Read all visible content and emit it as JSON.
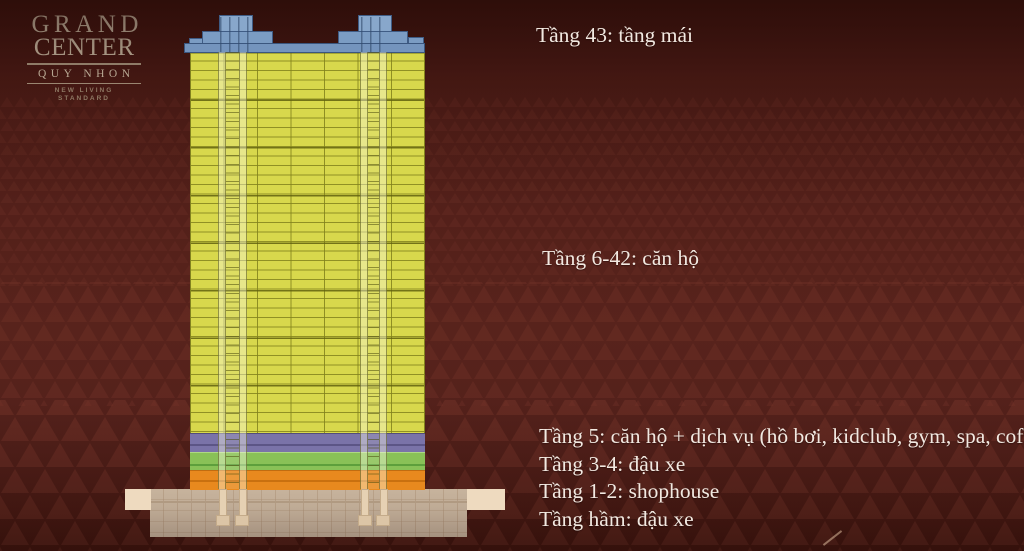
{
  "logo": {
    "title_line1": "GRAND",
    "title_line2": "CENTER",
    "subtitle": "QUY NHON",
    "tagline": "NEW LIVING STANDARD"
  },
  "annotations": {
    "roof": "Tầng 43: tầng mái",
    "apartments": "Tầng 6-42: căn hộ",
    "floor5": "Tầng 5: căn hộ + dịch vụ (hồ bơi, kidclub, gym, spa, coffee…",
    "floor3_4": "Tầng 3-4: đậu xe",
    "floor1_2": "Tầng 1-2: shophouse",
    "basement": "Tầng hầm: đậu xe"
  },
  "building": {
    "sections": [
      {
        "floors": "Tầng 43",
        "use": "tầng mái",
        "color": "#7b9cc3"
      },
      {
        "floors": "Tầng 6-42",
        "use": "căn hộ",
        "color": "#d8d84c"
      },
      {
        "floors": "Tầng 5",
        "use": "căn hộ + dịch vụ (hồ bơi, kidclub, gym, spa, coffee…",
        "color": "#7a73a8"
      },
      {
        "floors": "Tầng 3-4",
        "use": "đậu xe",
        "color": "#89c157"
      },
      {
        "floors": "Tầng 1-2",
        "use": "shophouse",
        "color": "#e8891e"
      },
      {
        "floors": "Tầng hầm",
        "use": "đậu xe",
        "color": "#eedabf"
      }
    ]
  },
  "colors": {
    "background": "#52201a",
    "annotation_text": "#f2e9e1",
    "logo_text": "#dccdb4",
    "roof_blue": "#7b9cc3",
    "facade_yellow": "#d8d84c"
  }
}
